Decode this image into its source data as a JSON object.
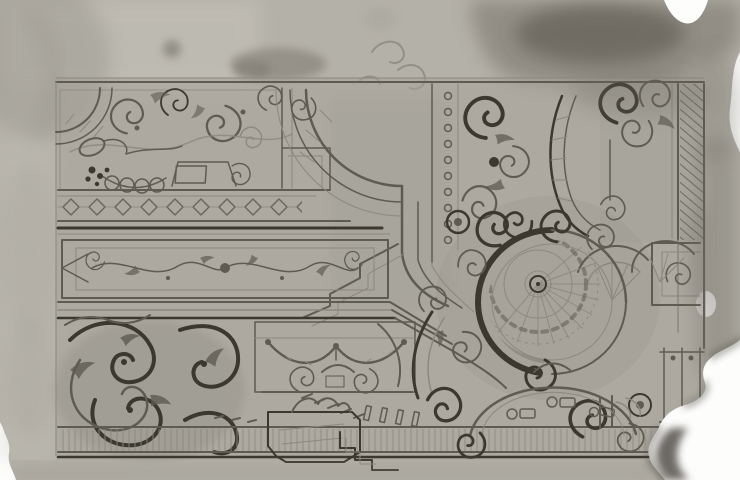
{
  "meta": {
    "type": "photograph-of-drawing",
    "subject": "Baroque ornamental design for a coved ceiling with domed oval cartouche, pen and gray wash on paper",
    "condition": "sheet stained at top right and torn at the bottom-right corner, photographed on a white backdrop"
  },
  "palette": {
    "backdrop": "#fdfdfc",
    "paper": "#b4b1a8",
    "paper_light": "#c6c3ba",
    "paper_dark": "#a5a29a",
    "wash": "#9d9a91",
    "ink_light": "#8b887e",
    "ink": "#5e5b51",
    "ink_dark": "#3b382f",
    "stain": "#6f6c63",
    "crust": "#49453c"
  }
}
